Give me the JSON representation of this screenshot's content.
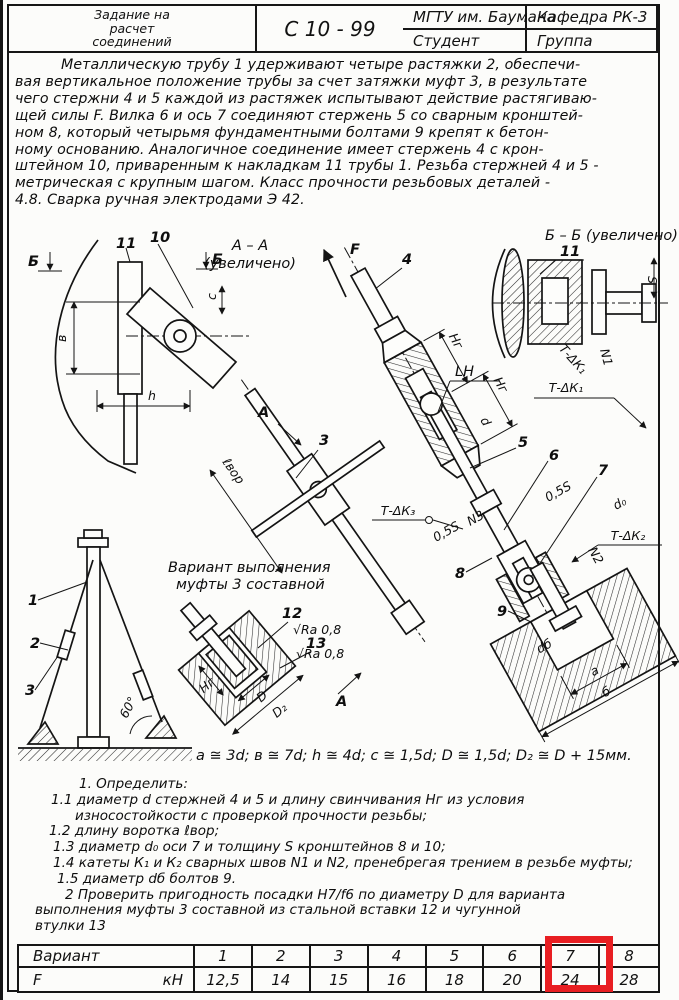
{
  "header": {
    "university": "МГТУ им. Баумана",
    "student_label": "Студент",
    "department": "Кафедра РК-3",
    "group_label": "Группа",
    "title_line1": "Задание на",
    "title_line2": "расчет",
    "title_line3": "соединений",
    "doc_code": "С 10 - 99"
  },
  "description": [
    "Металлическую трубу 1 удерживают четыре растяжки 2, обеспечи-",
    "вая вертикальное положение трубы за счет затяжки муфт 3, в результате",
    "чего стержни 4 и 5 каждой из растяжек испытывают действие растягиваю-",
    "щей силы F. Вилка 6 и ось 7 соединяют стержень 5 со сварным кронштей-",
    "ном 8, который четырьмя фундаментными болтами 9 крепят к бетон-",
    "ному основанию. Аналогичное соединение имеет стержень 4 с крон-",
    "штейном 10, приваренным к накладкам 11 трубы 1. Резьба стержней 4 и 5 -",
    "метрическая с крупным шагом. Класс прочности резьбовых деталей -",
    "4.8. Сварка ручная электродами Э 42."
  ],
  "drawing": {
    "view_aa_title": "А – А",
    "view_aa_sub": "(увеличено)",
    "view_bb_title": "Б – Б (увеличено)",
    "section_a": "А",
    "section_b": "Б",
    "force": "F",
    "thread": "LH",
    "part_1": "1",
    "part_2": "2",
    "part_3": "3",
    "part_4": "4",
    "part_5": "5",
    "part_6": "6",
    "part_7": "7",
    "part_8": "8",
    "part_9": "9",
    "part_10": "10",
    "part_11": "11",
    "part_12": "12",
    "part_13": "13",
    "dim_v": "в",
    "dim_h": "h",
    "dim_c": "c",
    "dim_d": "d",
    "dim_d0": "d₀",
    "dim_db": "dб",
    "dim_a": "a",
    "dim_b": "б",
    "dim_s": "S",
    "dim_half_s": "0,5S",
    "dim_hg": "Hг",
    "dim_lvor": "ℓвор",
    "dim_D": "D",
    "dim_D2": "D₂",
    "weld_n1": "N1",
    "weld_n2": "N2",
    "weld_n3": "N3",
    "callout_k1": "Т-ΔК₁",
    "callout_k2": "Т-ΔК₂",
    "callout_k3": "Т-ΔК₃",
    "angle_60": "60°",
    "roughness": "√Ra 0,8",
    "variant_note_1": "Вариант выполнения",
    "variant_note_2": "муфты 3 составной"
  },
  "formulas": {
    "text": "a ≅ 3d;   в ≅ 7d;   h ≅ 4d;   c ≅ 1,5d;   D ≅ 1,5d;   D₂ ≅ D + 15мм."
  },
  "tasks": [
    "1. Определить:",
    "1.1 диаметр d стержней 4 и 5 и длину свинчивания Hг из условия",
    "износостойкости с проверкой прочности резьбы;",
    "1.2 длину воротка ℓвор;",
    "1.3 диаметр d₀ оси 7 и толщину S кронштейнов 8 и 10;",
    "1.4 катеты К₁ и К₂ сварных швов N1 и N2, пренебрегая трением в резьбе муфты;",
    "1.5 диаметр dб болтов 9.",
    "2  Проверить пригодность посадки Н7/f6 по диаметру D для варианта",
    "выполнения муфты 3 составной из стальной вставки 12 и чугунной",
    "втулки 13"
  ],
  "variants_table": {
    "row_header": "Вариант",
    "force_symbol": "F",
    "force_unit": "кН",
    "variants": [
      "1",
      "2",
      "3",
      "4",
      "5",
      "6",
      "7",
      "8"
    ],
    "forces": [
      "12,5",
      "14",
      "15",
      "16",
      "18",
      "20",
      "24",
      "28"
    ],
    "highlighted_variant": "7",
    "highlight_color": "#e81e22"
  }
}
